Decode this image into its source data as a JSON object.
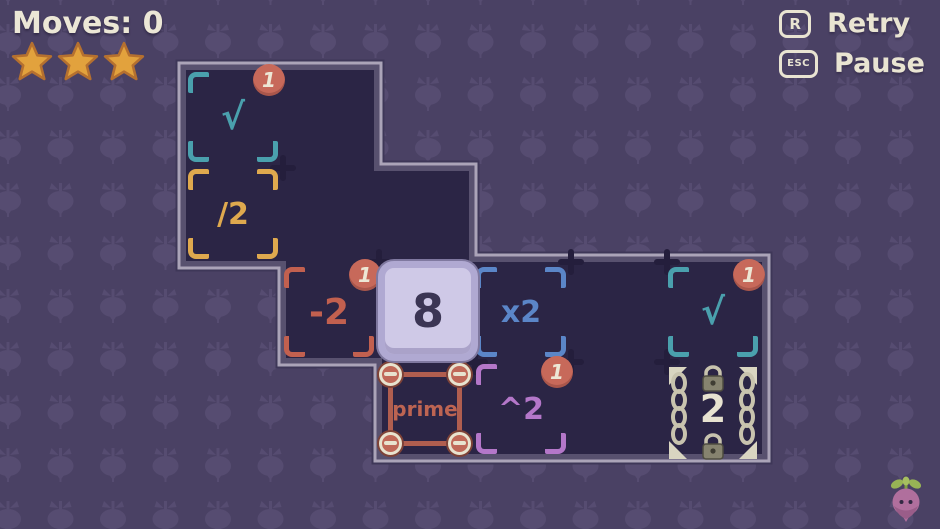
{
  "hud": {
    "moves_label": "Moves: 0",
    "stars_count": 3
  },
  "controls": {
    "retry": {
      "key": "R",
      "label": "Retry"
    },
    "pause": {
      "key": "ESC",
      "label": "Pause"
    }
  },
  "board": {
    "cells": [
      {
        "id": "sqrt-top",
        "label": "√",
        "badge": "1",
        "color": "#4aa0ad"
      },
      {
        "id": "divide-2",
        "label": "/2",
        "badge": null,
        "color": "#dfa94e"
      },
      {
        "id": "minus-2",
        "label": "-2",
        "badge": "1",
        "color": "#c2604f"
      },
      {
        "id": "times-2",
        "label": "x2",
        "badge": null,
        "color": "#5b86c8"
      },
      {
        "id": "sqrt-right",
        "label": "√",
        "badge": "1",
        "color": "#4aa0ad"
      },
      {
        "id": "prime",
        "label": "prime",
        "badge": null,
        "color": "#b05e4f"
      },
      {
        "id": "power-2",
        "label": "^2",
        "badge": "1",
        "color": "#b477c9"
      },
      {
        "id": "locked-2",
        "label": "2",
        "badge": null,
        "color": "#e7e2d0"
      }
    ],
    "player_tile": {
      "value": "8"
    }
  },
  "colors": {
    "background": "#4a4164",
    "background_motif": "#564c71",
    "board_interior": "#2b2545",
    "board_border_light": "#aba4b8",
    "board_border_dark": "#58516f",
    "badge": "#c7695a",
    "cream_text": "#e9e4d2",
    "star": "#e2a23d",
    "player_tile_fill": "#cfc9e7"
  },
  "icons": {
    "star": "star-icon",
    "retry_key": "r-keycap-icon",
    "pause_key": "esc-keycap-icon",
    "badge": "counter-badge",
    "chains": "chain-lock-icon",
    "mascot": "turnip-mascot-icon",
    "pattern": "turnip-pattern"
  }
}
